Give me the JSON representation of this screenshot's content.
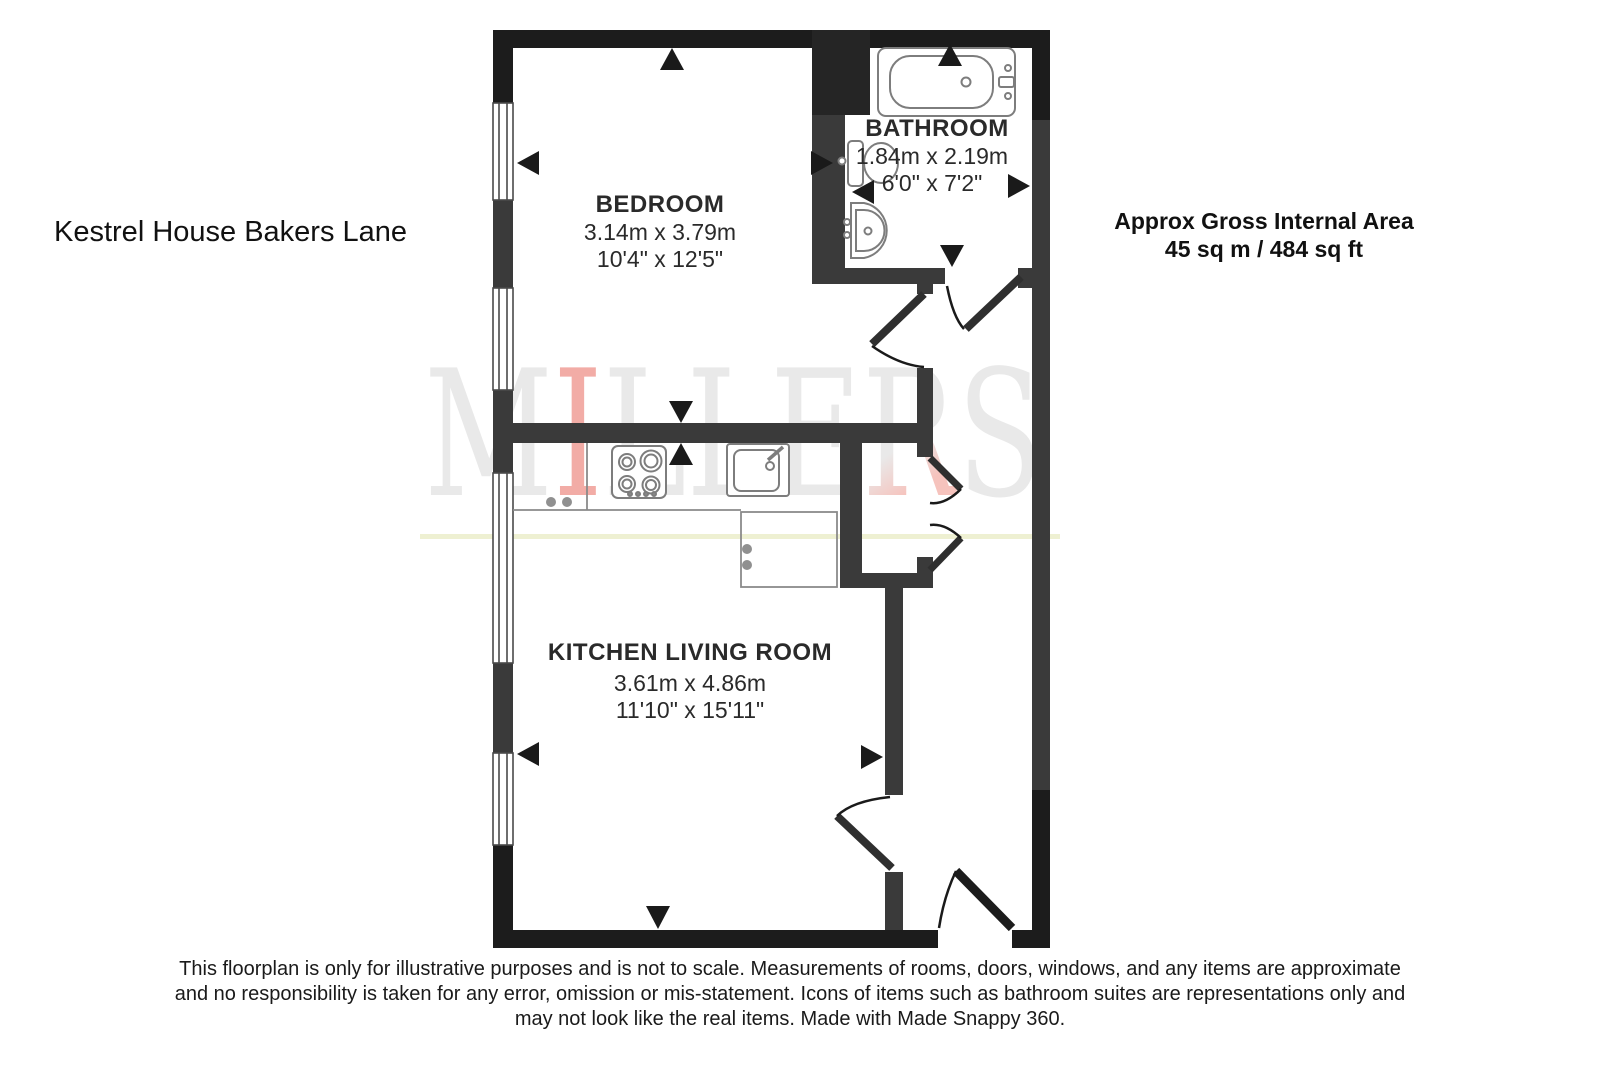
{
  "title": "Kestrel House Bakers Lane",
  "area_summary": {
    "line1": "Approx Gross Internal Area",
    "line2": "45 sq m / 484 sq ft"
  },
  "rooms": [
    {
      "id": "bedroom",
      "name": "BEDROOM",
      "metric": "3.14m x 3.79m",
      "imperial": "10'4\" x 12'5\""
    },
    {
      "id": "bathroom",
      "name": "BATHROOM",
      "metric": "1.84m x 2.19m",
      "imperial": "6'0\" x 7'2\""
    },
    {
      "id": "kitchen_living_room",
      "name": "KITCHEN LIVING ROOM",
      "metric": "3.61m x 4.86m",
      "imperial": "11'10\" x 15'11\""
    }
  ],
  "watermark": {
    "text": "MILLERS",
    "letters": [
      "M",
      "I",
      "L",
      "L",
      "E",
      "R",
      "S"
    ],
    "gray_color": "#e9e9e9",
    "red_color": "#f2aca6"
  },
  "disclaimer": {
    "line1": "This floorplan is only for illustrative purposes and is not to scale. Measurements of rooms, doors, windows, and any items are approximate",
    "line2": "and no responsibility is taken for any error, omission or mis-statement. Icons of items such as bathroom suites are representations only and",
    "line3": "may not look like the real items. Made with Made Snappy 360."
  },
  "icons": [
    "bathtub-icon",
    "toilet-icon",
    "basin-icon",
    "hob-icon",
    "kitchen-sink-icon",
    "window",
    "door-arc",
    "direction-arrow"
  ],
  "colors": {
    "outer_wall": "#1c1c1c",
    "inner_wall": "#3a3a3a",
    "fixture_outline": "#7d7d7d",
    "accent_line": "#eef0d2",
    "background": "#ffffff"
  }
}
